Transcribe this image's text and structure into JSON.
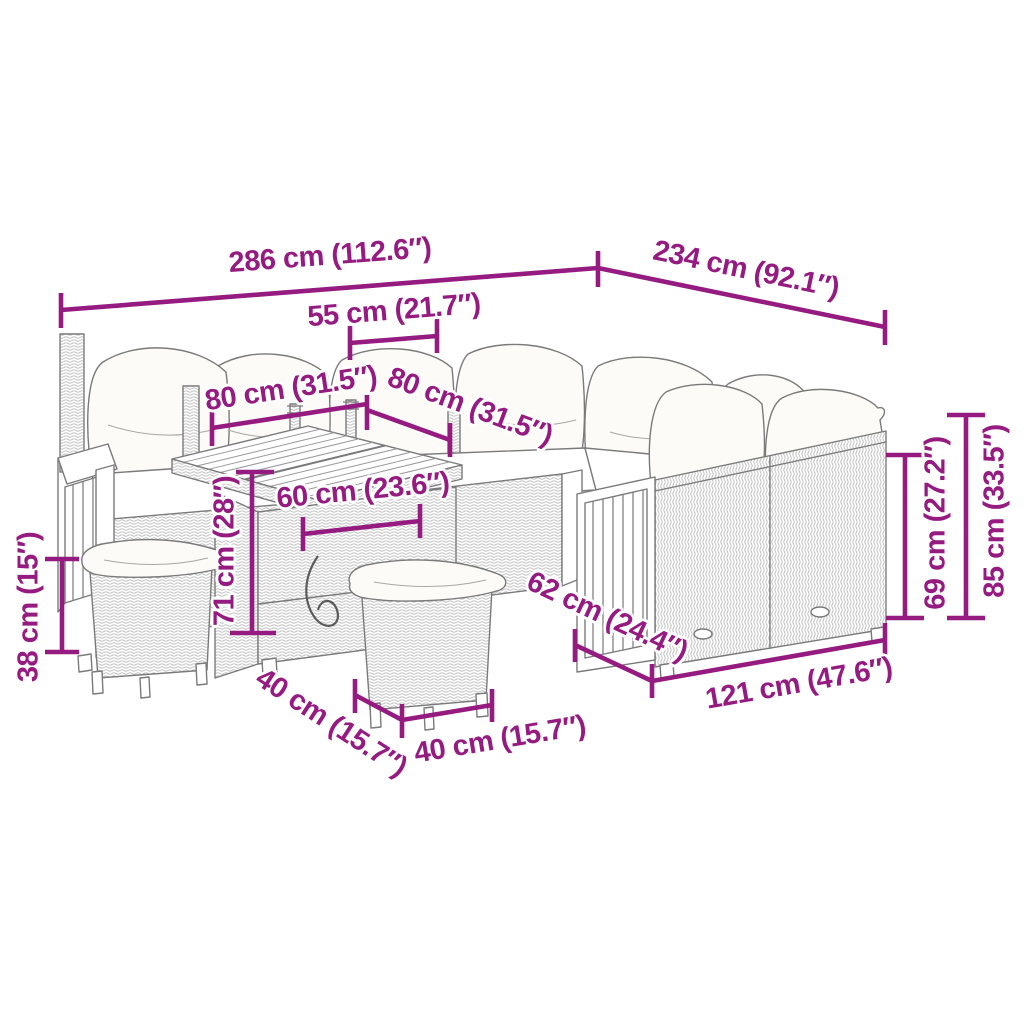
{
  "colors": {
    "dimension": "#951B81",
    "artwork_line": "#7A7A7A",
    "background": "#FFFFFF",
    "cushion_fill": "#FBFAF5"
  },
  "dimensions": [
    {
      "name": "total-width",
      "label": "286 cm (112.6″)"
    },
    {
      "name": "total-depth",
      "label": "234 cm (92.1″)"
    },
    {
      "name": "seat-width",
      "label": "55 cm (21.7″)"
    },
    {
      "name": "table-top-width",
      "label": "80 cm (31.5″)"
    },
    {
      "name": "table-top-depth",
      "label": "80 cm (31.5″)"
    },
    {
      "name": "table-base-width",
      "label": "60 cm (23.6″)"
    },
    {
      "name": "table-height",
      "label": "71 cm (28″)"
    },
    {
      "name": "stool-height",
      "label": "38 cm (15″)"
    },
    {
      "name": "stool-depth",
      "label": "40 cm (15.7″)"
    },
    {
      "name": "stool-width",
      "label": "40 cm (15.7″)"
    },
    {
      "name": "sofa-depth",
      "label": "62 cm (24.4″)"
    },
    {
      "name": "sofa-module-width",
      "label": "121 cm (47.6″)"
    },
    {
      "name": "armrest-height",
      "label": "69 cm (27.2″)"
    },
    {
      "name": "back-height",
      "label": "85 cm (33.5″)"
    }
  ]
}
